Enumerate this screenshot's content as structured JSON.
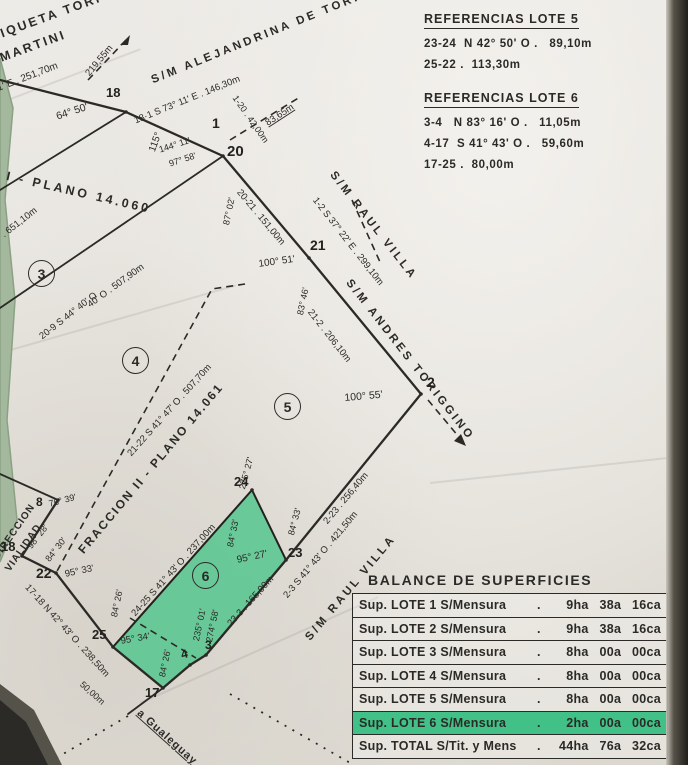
{
  "document_type": "Plano de mensura (scanned land survey plan)",
  "references": {
    "lote5": {
      "title": "REFERENCIAS LOTE 5",
      "rows": [
        "23-24  N 42° 50' O .   89,10m",
        "25-22 .  113,30m"
      ]
    },
    "lote6": {
      "title": "REFERENCIAS LOTE 6",
      "rows": [
        "3-4   N 83° 16' O .   11,05m",
        "4-17  S 41° 43' O .   59,60m",
        "17-25 .  80,00m"
      ]
    }
  },
  "balance": {
    "title": "BALANCE DE SUPERFICIES",
    "dot": ".",
    "highlight_color": "#41c187",
    "rows": [
      {
        "label": "Sup. LOTE 1 S/Mensura",
        "value": "9ha 38a 16ca",
        "highlight": false
      },
      {
        "label": "Sup. LOTE 2 S/Mensura",
        "value": "9ha 38a 16ca",
        "highlight": false
      },
      {
        "label": "Sup. LOTE 3 S/Mensura",
        "value": "8ha 00a 00ca",
        "highlight": false
      },
      {
        "label": "Sup. LOTE 4 S/Mensura",
        "value": "8ha 00a 00ca",
        "highlight": false
      },
      {
        "label": "Sup. LOTE 5 S/Mensura",
        "value": "8ha 00a 00ca",
        "highlight": false
      },
      {
        "label": "Sup. LOTE 6 S/Mensura",
        "value": "2ha 00a 00ca",
        "highlight": true
      },
      {
        "label": "Sup. TOTAL S/Tit. y Mens",
        "value": "44ha 76a 32ca",
        "highlight": false
      }
    ]
  },
  "map": {
    "ink": "#2b2a26",
    "parcel_fill": "#55c68e",
    "circled_lots": [
      "3",
      "4",
      "5",
      "6"
    ],
    "points": [
      "18",
      "1",
      "20",
      "21",
      "2",
      "24",
      "23",
      "3",
      "4",
      "17",
      "25",
      "22",
      "18",
      "8"
    ],
    "annotations": [
      "RIQUETA TORIGGINO",
      "EMARTINI",
      "S 73° 11' E . 251,70m",
      "219,55m",
      "S/M ALEJANDRINA DE TORIGGINO",
      "18·1 S 73° 11' E . 146,30m",
      "64° 50'",
      "115°",
      "144° 11'",
      "97° 58'",
      "87° 02'",
      "1-20 . 42,00m",
      "83,65m",
      "20-21 . 151,00m",
      "S/M RAUL VILLA",
      "1-2 S 37° 22' E . 299,10m",
      "21-2 . 206,10m",
      "S/M ANDRES TORIGGINO",
      "100° 51'",
      "83° 46'",
      "100° 55'",
      "2-23 . 256,40m",
      "2-3 S 41° 43' O . 421,50m",
      "S/M RAUL VILLA",
      "23-3 . 165,90m",
      "24-25 S 41° 43' O . 237,00m",
      "84° 33'",
      "95° 27'",
      "275° 27'",
      "84° 33'",
      "95° 33'",
      "98° 28'",
      "84° 30'",
      "76° 39'",
      "84° 26'",
      "95° 34'",
      "84° 26'",
      "235° 01'",
      "274° 58'",
      "17-18 N 42° 43' O . 238,50m",
      "50,00m",
      "a Gualeguay",
      "DIRECCION",
      "VIALIDAD",
      "FRACCION II - PLANO 14.061",
      "21-22 S 41° 47' O . 507,70m",
      "I - PLANO 14.060",
      ". 651,10m",
      "20-9 S 44° 40' O .",
      "40' O . 507,90m"
    ]
  }
}
